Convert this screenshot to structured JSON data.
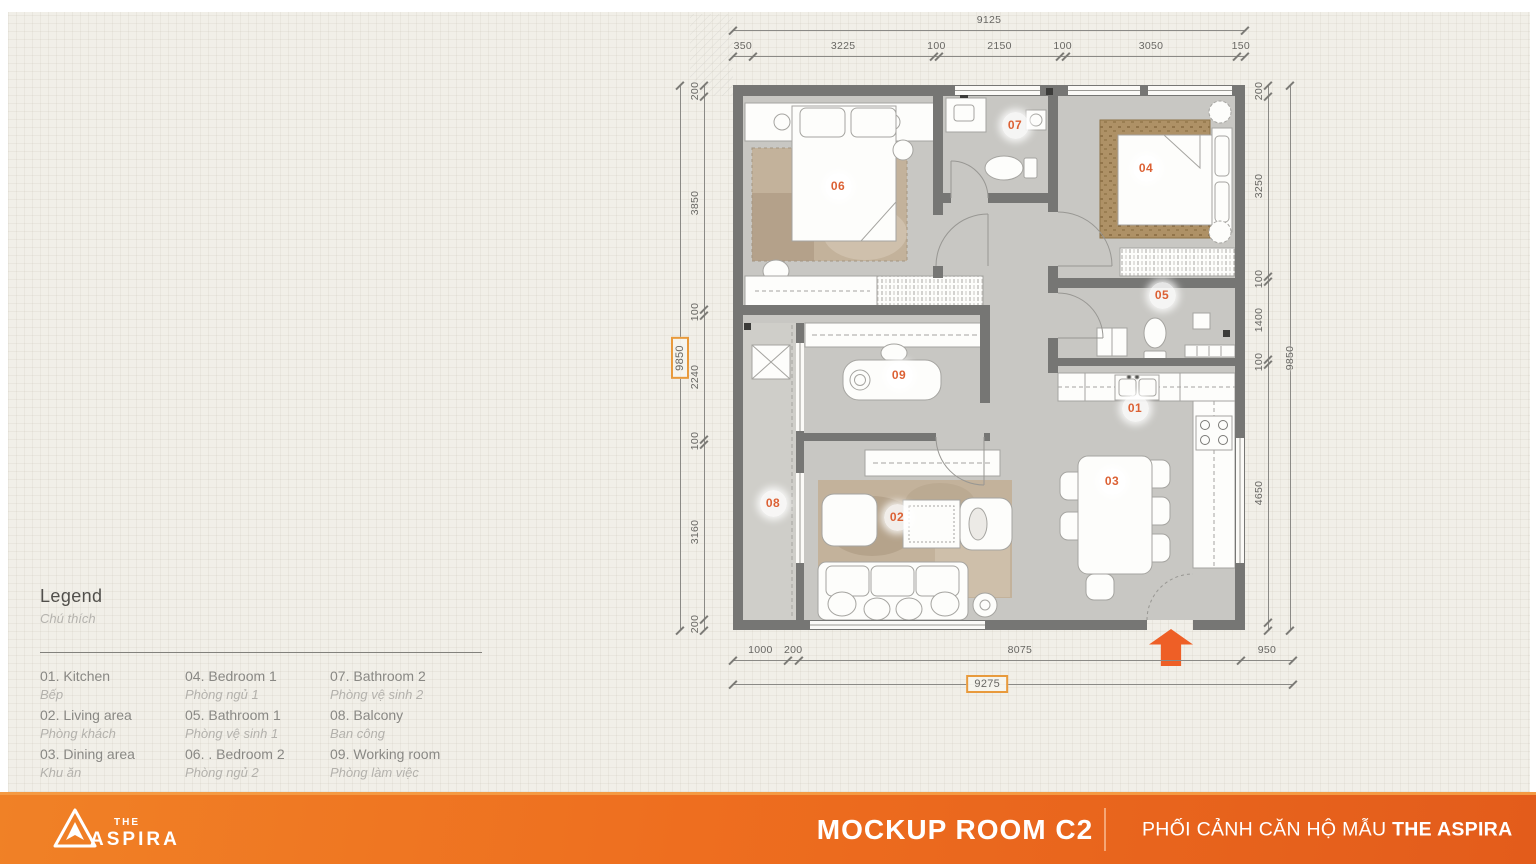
{
  "legend": {
    "title": "Legend",
    "subtitle": "Chú thích",
    "items": [
      {
        "en": "01. Kitchen",
        "vi": "Bếp"
      },
      {
        "en": "02. Living area",
        "vi": "Phòng khách"
      },
      {
        "en": "03. Dining area",
        "vi": "Khu ăn"
      },
      {
        "en": "04. Bedroom 1",
        "vi": "Phòng ngủ 1"
      },
      {
        "en": "05. Bathroom 1",
        "vi": "Phòng vệ sinh 1"
      },
      {
        "en": "06. . Bedroom 2",
        "vi": "Phòng ngủ 2"
      },
      {
        "en": "07. Bathroom 2",
        "vi": "Phòng vệ sinh 2"
      },
      {
        "en": "08. Balcony",
        "vi": "Ban công"
      },
      {
        "en": "09. Working room",
        "vi": "Phòng làm việc"
      }
    ]
  },
  "plan": {
    "rooms": [
      {
        "label": "01",
        "name": "Kitchen"
      },
      {
        "label": "02",
        "name": "Living area"
      },
      {
        "label": "03",
        "name": "Dining area"
      },
      {
        "label": "04",
        "name": "Bedroom 1"
      },
      {
        "label": "05",
        "name": "Bathroom 1"
      },
      {
        "label": "06",
        "name": "Bedroom 2"
      },
      {
        "label": "07",
        "name": "Bathroom 2"
      },
      {
        "label": "08",
        "name": "Balcony"
      },
      {
        "label": "09",
        "name": "Working room"
      }
    ],
    "dims": {
      "top": {
        "overall": "9125",
        "segments": [
          "350",
          "3225",
          "100",
          "2150",
          "100",
          "3050",
          "150"
        ]
      },
      "left": {
        "overall": "9850",
        "segments": [
          "200",
          "3850",
          "100",
          "2240",
          "100",
          "3160",
          "200"
        ]
      },
      "right": {
        "overall": "9850",
        "segments": [
          "200",
          "3250",
          "100",
          "1400",
          "100",
          "4650"
        ]
      },
      "bottom": {
        "overall": "9275",
        "segments": [
          "1000",
          "200",
          "8075",
          "950"
        ]
      }
    }
  },
  "footer": {
    "logo": {
      "the": "THE",
      "aspira": "ASPIRA"
    },
    "title": "MOCKUP ROOM C2",
    "subtitle": "PHỐI CẢNH CĂN HỘ MẪU ",
    "subtitle_bold": "THE ASPIRA"
  },
  "colors": {
    "accent_orange": "#ee6e1f",
    "entrance_arrow": "#ee5f26",
    "dim_highlight_border": "#e89a3c",
    "badge_number": "#dc6134",
    "wall": "#767674",
    "floor": "#c8c7c3",
    "rug": "#c3b29b"
  }
}
